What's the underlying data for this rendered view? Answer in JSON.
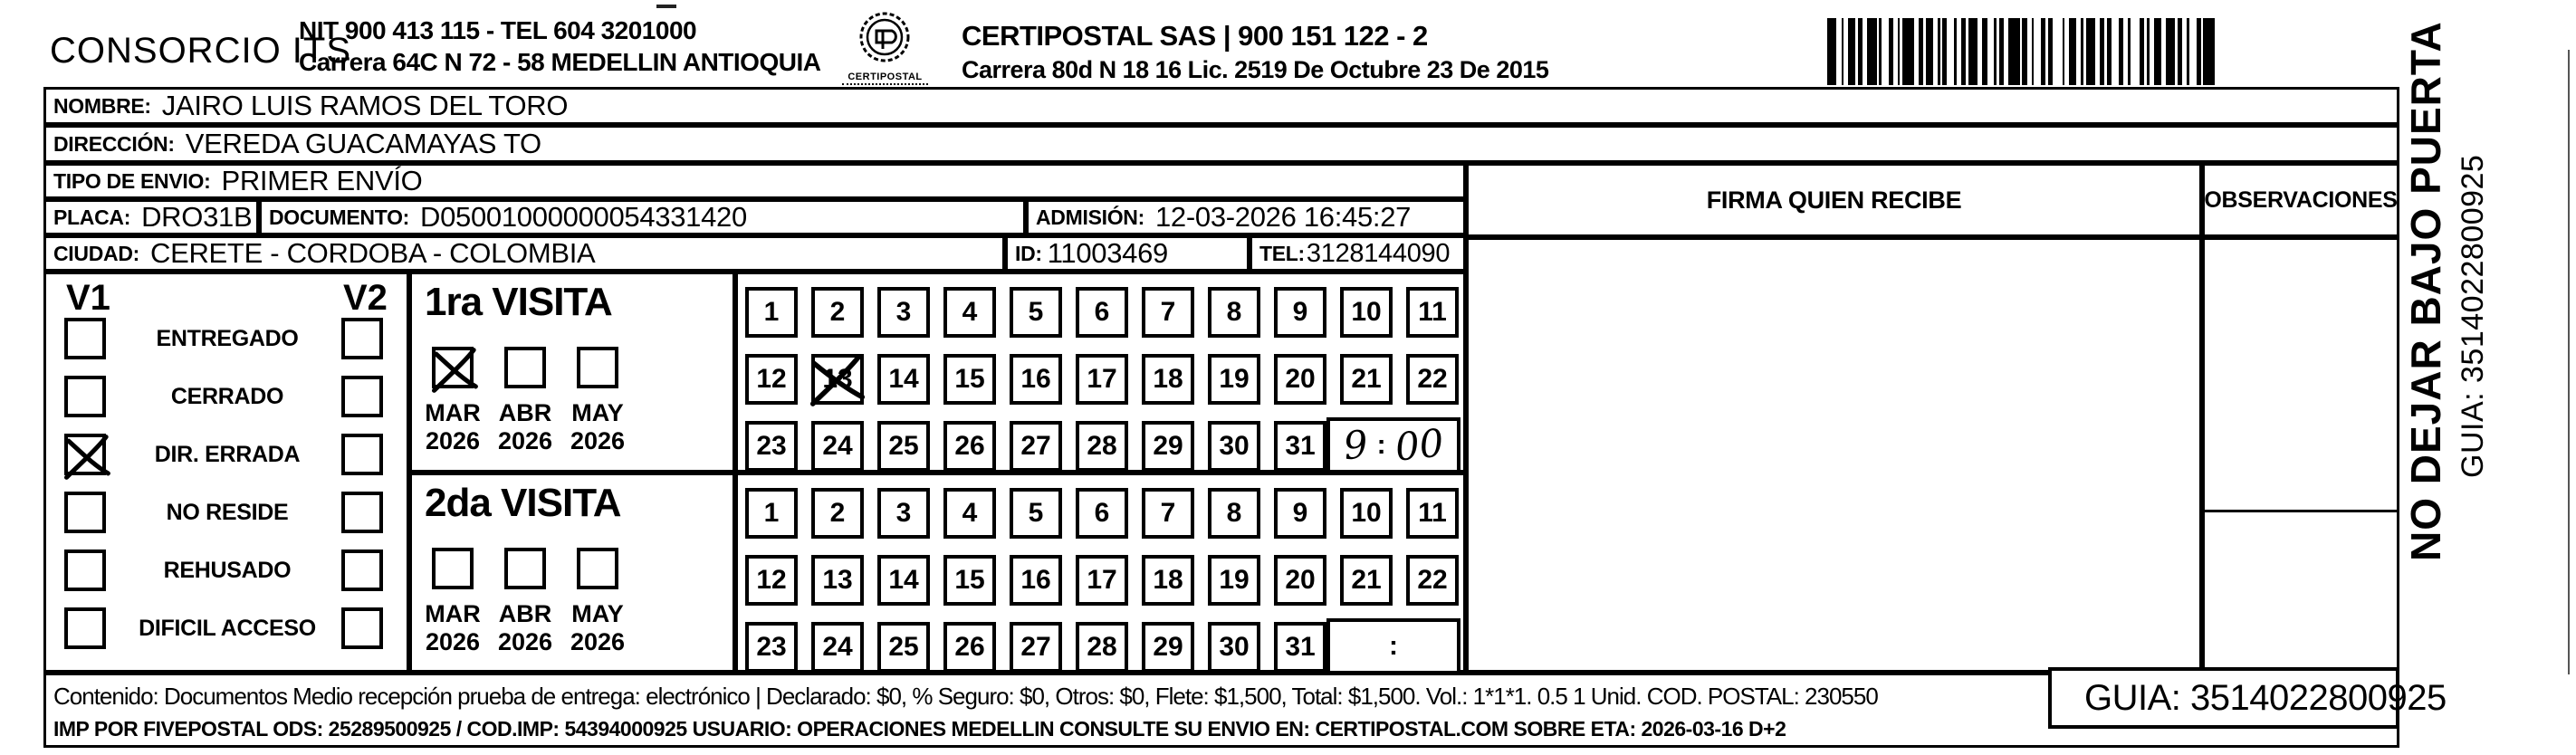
{
  "colors": {
    "ink": "#000000",
    "paper": "#ffffff"
  },
  "header": {
    "company": "CONSORCIO ITS",
    "company_info_line1": "NIT 900 413 115 - TEL 604 3201000",
    "company_info_line2": "Carrera 64C N 72 - 58 MEDELLIN ANTIOQUIA",
    "logo_caption": "CERTIPOSTAL",
    "operator": "CERTIPOSTAL SAS | 900 151 122 - 2",
    "operator_info": "Carrera 80d N 18 16  Lic. 2519 De Octubre 23 De 2015"
  },
  "fields": {
    "nombre_label": "NOMBRE:",
    "nombre": "JAIRO LUIS RAMOS DEL TORO",
    "direccion_label": "DIRECCIÓN:",
    "direccion": "VEREDA GUACAMAYAS TO",
    "tipo_label": "TIPO DE ENVIO:",
    "tipo": "PRIMER ENVÍO",
    "placa_label": "PLACA:",
    "placa": "DRO31B",
    "documento_label": "DOCUMENTO:",
    "documento": "D05001000000054331420",
    "admision_label": "ADMISIÓN:",
    "admision": "12-03-2026 16:45:27",
    "ciudad_label": "CIUDAD:",
    "ciudad": "CERETE - CORDOBA - COLOMBIA",
    "id_label": "ID:",
    "id": "11003469",
    "tel_label": "TEL:",
    "tel": "3128144090"
  },
  "status_panel": {
    "v1_label": "V1",
    "v2_label": "V2",
    "rows": [
      {
        "label": "ENTREGADO",
        "v1": false,
        "v2": false
      },
      {
        "label": "CERRADO",
        "v1": false,
        "v2": false
      },
      {
        "label": "DIR. ERRADA",
        "v1": true,
        "v2": false
      },
      {
        "label": "NO RESIDE",
        "v1": false,
        "v2": false
      },
      {
        "label": "REHUSADO",
        "v1": false,
        "v2": false
      },
      {
        "label": "DIFICIL ACCESO",
        "v1": false,
        "v2": false
      }
    ]
  },
  "day_numbers": [
    1,
    2,
    3,
    4,
    5,
    6,
    7,
    8,
    9,
    10,
    11,
    12,
    13,
    14,
    15,
    16,
    17,
    18,
    19,
    20,
    21,
    22,
    23,
    24,
    25,
    26,
    27,
    28,
    29,
    30,
    31
  ],
  "time_colon": ":",
  "visits": [
    {
      "title": "1ra VISITA",
      "months": [
        {
          "label": "MAR",
          "year": "2026",
          "checked": true
        },
        {
          "label": "ABR",
          "year": "2026",
          "checked": false
        },
        {
          "label": "MAY",
          "year": "2026",
          "checked": false
        }
      ],
      "crossed_day": 13,
      "time": "9:00"
    },
    {
      "title": "2da VISITA",
      "months": [
        {
          "label": "MAR",
          "year": "2026",
          "checked": false
        },
        {
          "label": "ABR",
          "year": "2026",
          "checked": false
        },
        {
          "label": "MAY",
          "year": "2026",
          "checked": false
        }
      ],
      "crossed_day": null,
      "time": ""
    }
  ],
  "right_panel": {
    "firma_header": "FIRMA QUIEN RECIBE",
    "observaciones_header": "OBSERVACIONES"
  },
  "side_text": {
    "line1": "NO DEJAR BAJO PUERTA",
    "line2": "GUIA: 3514022800925"
  },
  "footer": {
    "line1": "Contenido: Documentos Medio recepción prueba de entrega: electrónico | Declarado: $0, % Seguro: $0, Otros: $0, Flete: $1,500, Total: $1,500. Vol.: 1*1*1. 0.5  1 Unid. COD. POSTAL: 230550",
    "line2": "IMP POR FIVEPOSTAL ODS: 25289500925 / COD.IMP: 54394000925 USUARIO: OPERACIONES MEDELLIN CONSULTE SU ENVIO EN: CERTIPOSTAL.COM SOBRE ETA: 2026-03-16 D+2",
    "guia": "GUIA: 3514022800925"
  }
}
